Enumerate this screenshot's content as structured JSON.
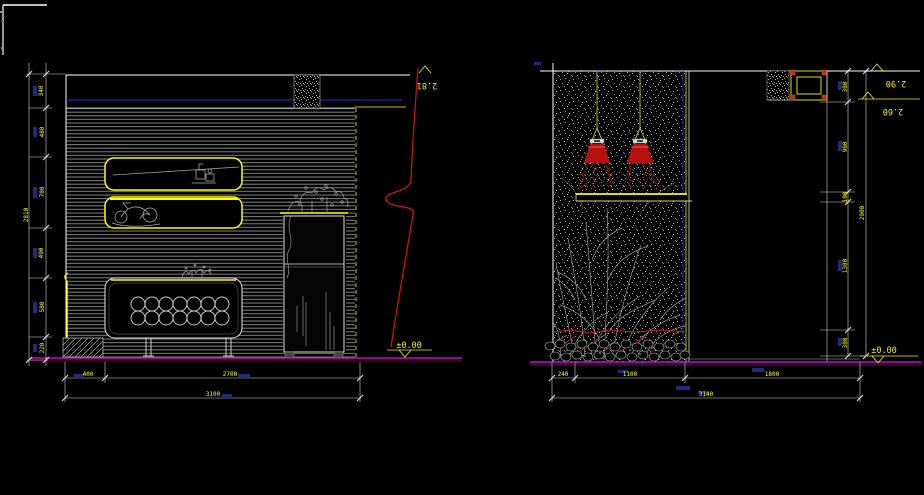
{
  "app": {
    "background": "#000000",
    "cursor": "crosshair"
  },
  "colors": {
    "wall_hatch_gray": "#8f8f8f",
    "outline_yellow": "#ffff00",
    "ceiling_blue": "#2233cc",
    "break_line_red": "#cc1111",
    "lamp_red": "#cc1111",
    "floor_magenta": "#ff00ff",
    "dim_line": "#d8d8d8",
    "dim_text_yellow": "#ffff00",
    "ghost_text_blue": "#1c2d7d",
    "sketch_gray": "#a5a5a5",
    "grass_green": "#22aa22"
  },
  "left_view": {
    "elevation_top": "2.81",
    "elevation_floor": "±0.00",
    "dims_vertical": [
      "340",
      "480",
      "700",
      "490",
      "580",
      "220"
    ],
    "dims_vertical_total": "2810",
    "dims_bottom": [
      "400",
      "2700"
    ],
    "dims_bottom_total": "3100"
  },
  "right_view": {
    "elevation_top": "2.90",
    "elevation_shelf": "2.60",
    "elevation_floor": "±0.00",
    "dims_vertical": [
      "300",
      "900",
      "100",
      "1300",
      "300"
    ],
    "dims_vertical_total": "2900",
    "dims_bottom": [
      "240",
      "1100",
      "1800"
    ],
    "dims_bottom_total": "3140"
  }
}
